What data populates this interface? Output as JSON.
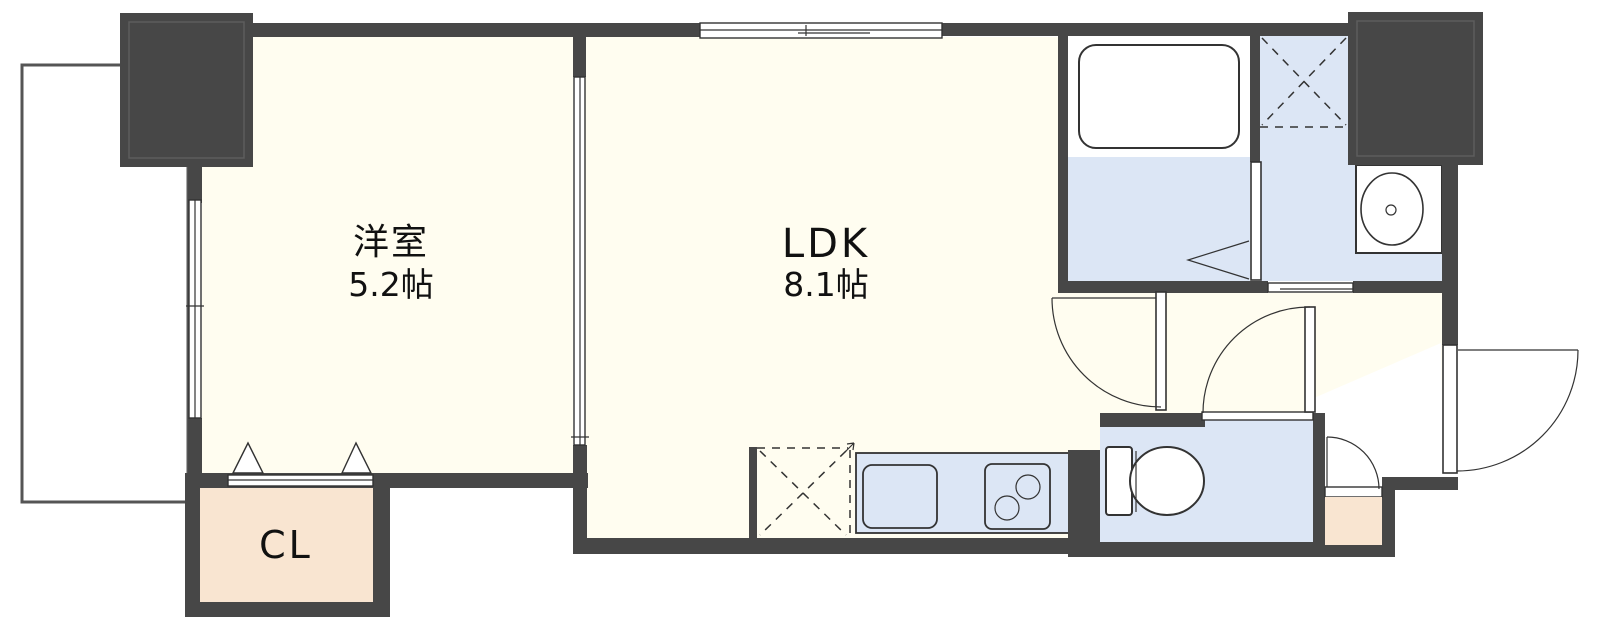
{
  "plan": {
    "type": "apartment-floor-plan",
    "rooms": {
      "western_room": {
        "label": "洋室",
        "area": "5.2帖"
      },
      "ldk": {
        "label": "LDK",
        "area": "8.1帖"
      },
      "closet": {
        "label": "CL"
      }
    },
    "colors": {
      "wall": "#474747",
      "wall_inner_line": "#5d5d5d",
      "floor": "#FFFDF0",
      "wet_area": "#DCE6F5",
      "storage": "#F9E5D1",
      "outline": "#333333",
      "balcony_line": "#555555",
      "background": "#FFFFFF",
      "text": "#111111"
    }
  }
}
